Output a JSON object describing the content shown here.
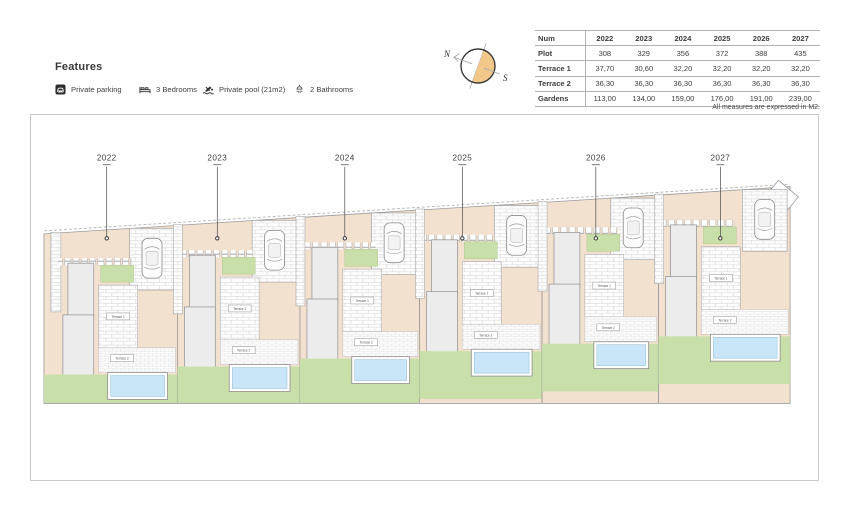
{
  "features": {
    "heading": "Features",
    "items": [
      {
        "icon": "parking-icon",
        "label": "Private parking"
      },
      {
        "icon": "bed-icon",
        "label": "3 Bedrooms"
      },
      {
        "icon": "pool-icon",
        "label": "Private pool (21m2)"
      },
      {
        "icon": "bathroom-icon",
        "label": "2 Bathrooms"
      }
    ]
  },
  "compass": {
    "north_label": "N",
    "south_label": "S",
    "accent_color": "#f2c88a"
  },
  "table": {
    "columns": [
      "Num",
      "2022",
      "2023",
      "2024",
      "2025",
      "2026",
      "2027"
    ],
    "rows": [
      {
        "label": "Plot",
        "values": [
          "308",
          "329",
          "356",
          "372",
          "388",
          "435"
        ]
      },
      {
        "label": "Terrace 1",
        "values": [
          "37,70",
          "30,60",
          "32,20",
          "32,20",
          "32,20",
          "32,20"
        ]
      },
      {
        "label": "Terrace 2",
        "values": [
          "36,30",
          "36,30",
          "36,30",
          "36,30",
          "36,30",
          "36,30"
        ]
      },
      {
        "label": "Gardens",
        "values": [
          "113,00",
          "134,00",
          "159,00",
          "176,00",
          "191,00",
          "239,00"
        ]
      }
    ],
    "footnote": "All measures are expressed in M2."
  },
  "plan": {
    "plots": [
      {
        "id": "2022"
      },
      {
        "id": "2023"
      },
      {
        "id": "2024"
      },
      {
        "id": "2025"
      },
      {
        "id": "2026"
      },
      {
        "id": "2027"
      }
    ],
    "terrace1_label": "Terrace 1",
    "terrace2_label": "Terrace 2",
    "colors": {
      "plot_fill": "#f3e1d0",
      "lawn": "#c9dfa9",
      "pool": "#c8e6f8",
      "house": "#ececec"
    }
  }
}
